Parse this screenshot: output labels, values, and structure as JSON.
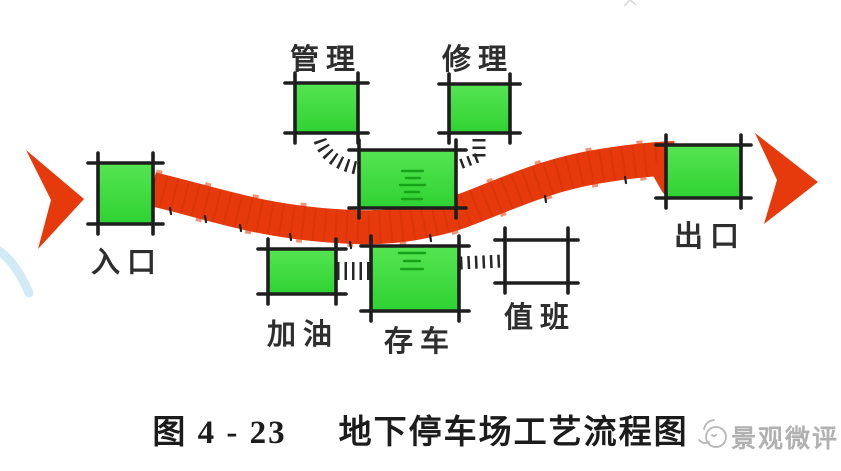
{
  "figure": {
    "caption_number": "图 4 - 23",
    "caption_title": "地下停车场工艺流程图"
  },
  "watermark": {
    "text": "景观微评",
    "logo": "cartoon-mascot-icon"
  },
  "diagram": {
    "type": "flow-diagram",
    "flow_direction": "left-to-right",
    "nodes": [
      {
        "id": "entrance",
        "label": "入口",
        "shape": "green-box"
      },
      {
        "id": "management",
        "label": "管理",
        "shape": "green-box"
      },
      {
        "id": "repair",
        "label": "修理",
        "shape": "green-box"
      },
      {
        "id": "refuel",
        "label": "加油",
        "shape": "green-box"
      },
      {
        "id": "parking",
        "label": "存车",
        "shape": "green-box"
      },
      {
        "id": "duty",
        "label": "值班",
        "shape": "white-box"
      },
      {
        "id": "exit",
        "label": "出口",
        "shape": "green-box"
      },
      {
        "id": "hall",
        "label": "",
        "shape": "green-box"
      }
    ]
  },
  "colors": {
    "box_green": "#3fdd3f",
    "box_green_light": "#55e552",
    "flow_red": "#e63a0c",
    "outline_black": "#1e1e1e",
    "duty_white": "#ffffff",
    "watermark_gray": "#b1b1b1",
    "swoosh_blue": "#d2eaf6"
  }
}
